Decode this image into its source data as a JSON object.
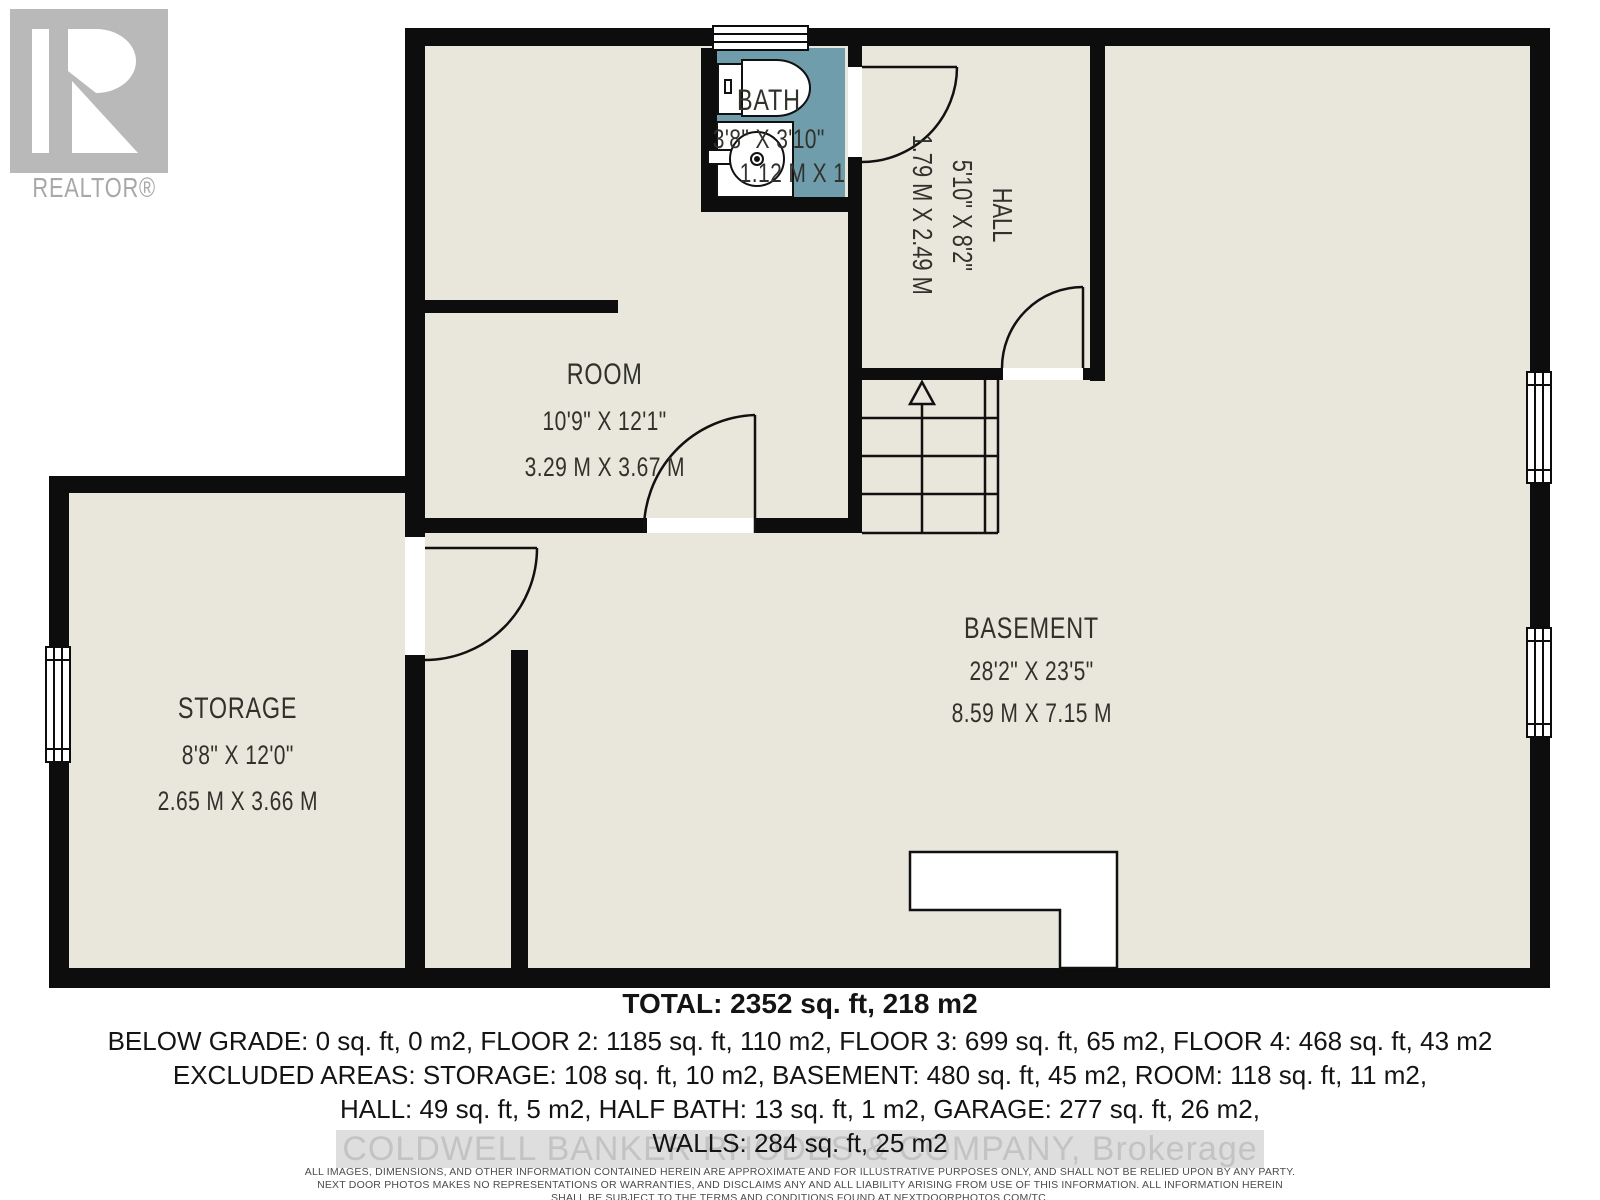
{
  "branding": {
    "realtor_logo_text": "REALTOR®",
    "watermark": "COLDWELL BANKER RHODES & COMPANY, Brokerage"
  },
  "rooms": {
    "bath": {
      "name": "BATH",
      "dims_ft": "3'8\" X 3'10\"",
      "dims_m": "1.12 M X 1.17 M"
    },
    "hall": {
      "name": "HALL",
      "dims_ft": "5'10\" X 8'2\"",
      "dims_m": "1.79 M X 2.49 M"
    },
    "room": {
      "name": "ROOM",
      "dims_ft": "10'9\" X 12'1\"",
      "dims_m": "3.29 M X 3.67 M"
    },
    "storage": {
      "name": "STORAGE",
      "dims_ft": "8'8\" X 12'0\"",
      "dims_m": "2.65 M X 3.66 M"
    },
    "basement": {
      "name": "BASEMENT",
      "dims_ft": "28'2\" X 23'5\"",
      "dims_m": "8.59 M X 7.15 M"
    }
  },
  "summary": {
    "total": "TOTAL: 2352 sq. ft, 218 m2",
    "line2": "BELOW GRADE: 0 sq. ft, 0 m2, FLOOR 2: 1185 sq. ft, 110 m2, FLOOR 3: 699 sq. ft, 65 m2, FLOOR 4: 468 sq. ft, 43 m2",
    "line3": "EXCLUDED AREAS: STORAGE: 108 sq. ft, 10 m2, BASEMENT: 480 sq. ft, 45 m2, ROOM: 118 sq. ft, 11 m2,",
    "line4": "HALL: 49 sq. ft, 5 m2, HALF BATH: 13 sq. ft, 1 m2, GARAGE: 277 sq. ft, 26 m2,",
    "line5": "WALLS: 284 sq. ft, 25 m2"
  },
  "disclaimer": {
    "line1": "ALL IMAGES, DIMENSIONS, AND OTHER INFORMATION CONTAINED HEREIN ARE APPROXIMATE AND FOR ILLUSTRATIVE PURPOSES ONLY, AND SHALL NOT BE RELIED UPON BY ANY PARTY.",
    "line2": "NEXT DOOR PHOTOS MAKES NO REPRESENTATIONS OR WARRANTIES, AND DISCLAIMS ANY AND ALL LIABILITY ARISING FROM USE OF THIS INFORMATION. ALL INFORMATION HEREIN",
    "line3": "SHALL BE SUBJECT TO THE TERMS AND CONDITIONS FOUND AT NEXTDOORPHOTOS.COM/TC."
  },
  "colors": {
    "floor": "#e9e6db",
    "wall": "#0d0d0d",
    "bath_fill": "#6f9dab",
    "label_text": "#32322d",
    "watermark_text": "#c3c3c3",
    "logo_gray": "#b9b9b9"
  }
}
